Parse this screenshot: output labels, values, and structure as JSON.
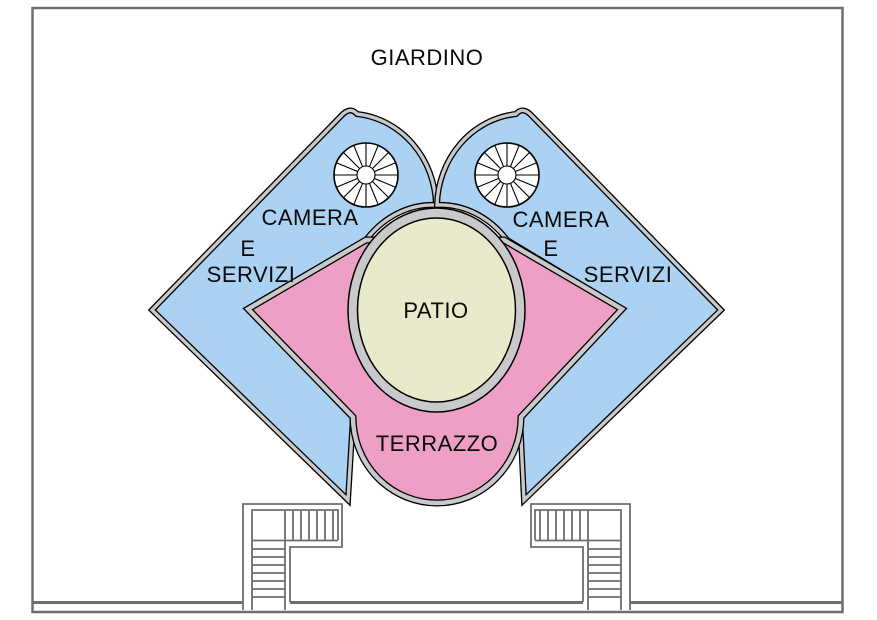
{
  "drawing": {
    "garden_label": "GIARDINO",
    "patio_label": "PATIO",
    "terrace_label": "TERRAZZO",
    "left_wing": {
      "line1": "CAMERA",
      "line2": "E",
      "line3": "SERVIZI"
    },
    "right_wing": {
      "line1": "CAMERA",
      "line2": "E",
      "line3": "SERVIZI"
    }
  },
  "colors": {
    "wing_fill": "#abd2f2",
    "terrace_fill": "#ee9fc6",
    "patio_fill": "#e9e9cc",
    "wall_gray": "#c9c9c9",
    "line_gray": "#6e6e6e",
    "outline_black": "#000000",
    "background": "#ffffff"
  }
}
